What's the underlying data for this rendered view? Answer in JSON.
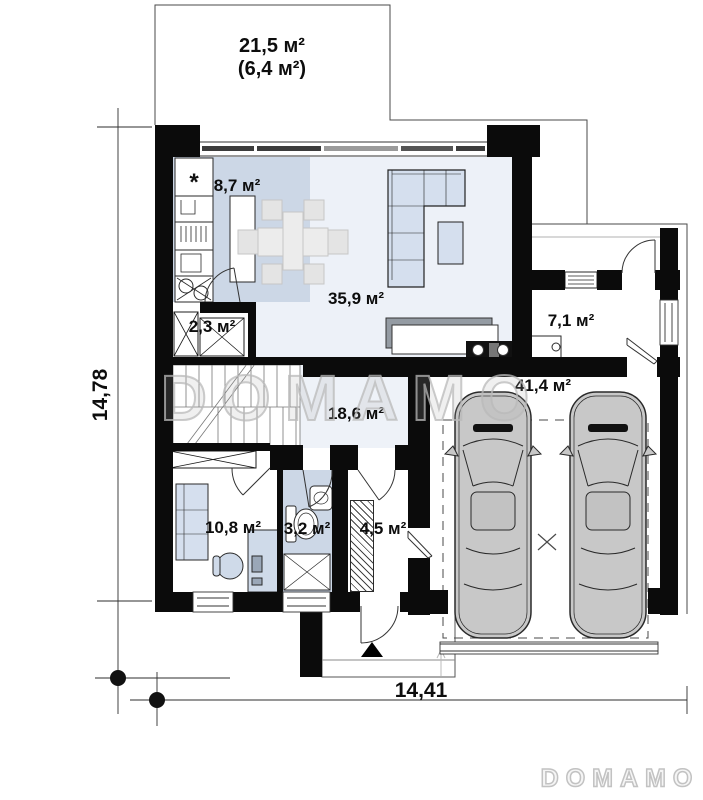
{
  "watermark": {
    "text": "DOMAMO"
  },
  "brand_logo": {
    "text": "DOMAMO"
  },
  "dimensions": {
    "height_label": "14,78",
    "width_label": "14,41"
  },
  "terrace": {
    "area": "21,5 м²",
    "area_secondary": "(6,4 м²)"
  },
  "rooms": [
    {
      "name": "kitchen",
      "area": "8,7 м²"
    },
    {
      "name": "living-room",
      "area": "35,9 м²"
    },
    {
      "name": "pantry",
      "area": "2,3 м²"
    },
    {
      "name": "vestibule",
      "area": "7,1 м²"
    },
    {
      "name": "hall",
      "area": "18,6 м²"
    },
    {
      "name": "garage",
      "area": "41,4 м²"
    },
    {
      "name": "office",
      "area": "10,8 м²"
    },
    {
      "name": "bathroom",
      "area": "3,2 м²"
    },
    {
      "name": "boiler-room",
      "area": "4,5 м²"
    }
  ],
  "symbols": {
    "fridge": "*"
  }
}
